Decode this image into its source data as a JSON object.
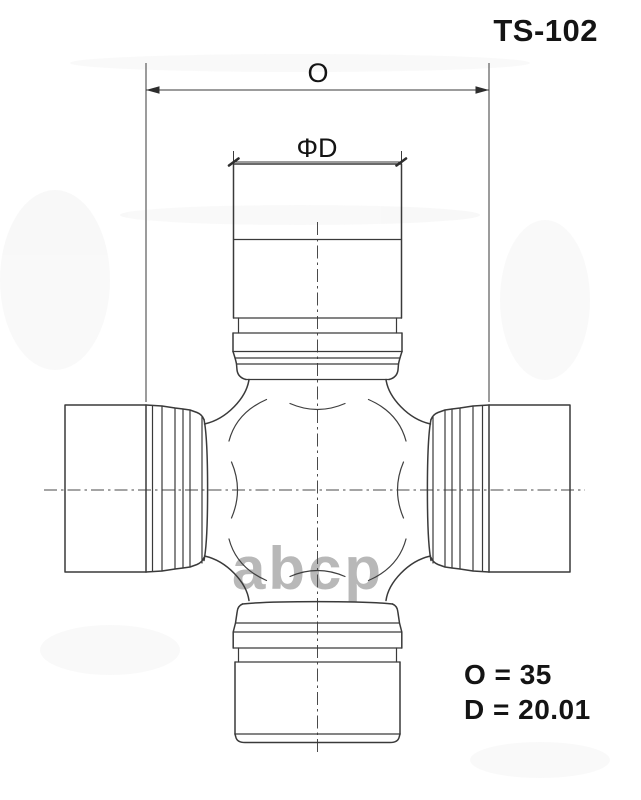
{
  "title": "TS-102",
  "dimensions": {
    "o": {
      "label": "O",
      "value": 35,
      "display": "O = 35"
    },
    "d": {
      "label": "ΦD",
      "value": 20.01,
      "display": "D = 20.01"
    }
  },
  "watermark": "abcp",
  "colors": {
    "line": "#3a3a3a",
    "text": "#141414",
    "watermark": "#b5b5b5",
    "background": "#ffffff"
  }
}
